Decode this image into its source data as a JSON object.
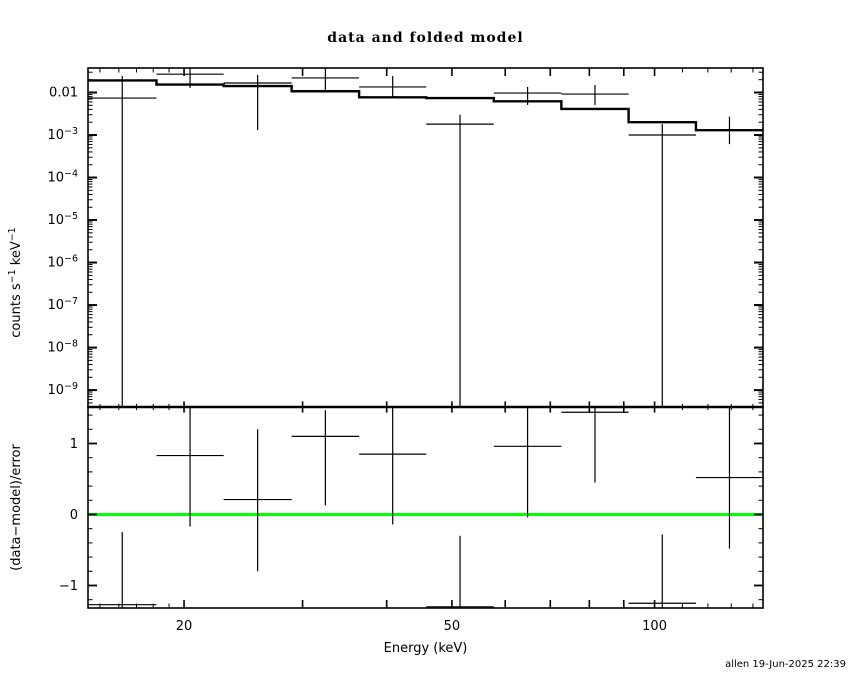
{
  "chart_data": {
    "type": "line",
    "title": "data and folded model",
    "footer": "allen 19-Jun-2025 22:39",
    "xlabel": "Energy (keV)",
    "xscale": "log",
    "xlim": [
      14.4,
      144.9
    ],
    "xticks": {
      "major": [
        20,
        30,
        40,
        50,
        60,
        70,
        80,
        90,
        100
      ],
      "minor": [
        15,
        16,
        17,
        18,
        19,
        110,
        120,
        130,
        140
      ],
      "labeled": [
        {
          "v": 20,
          "label": "20"
        },
        {
          "v": 50,
          "label": "50"
        },
        {
          "v": 100,
          "label": "100"
        }
      ]
    },
    "bin_edges_keV": [
      14.4,
      18.2,
      22.9,
      28.9,
      36.4,
      45.8,
      57.7,
      72.7,
      91.5,
      115.2,
      144.9
    ],
    "top_panel": {
      "ylabel": "counts s^-1 keV^-1",
      "yscale": "log",
      "ylim": [
        4e-10,
        0.0377
      ],
      "yticks": [
        {
          "v": 0.01,
          "label": "0.01"
        },
        {
          "v": 0.001,
          "label": "10^-3"
        },
        {
          "v": 0.0001,
          "label": "10^-4"
        },
        {
          "v": 1e-05,
          "label": "10^-5"
        },
        {
          "v": 1e-06,
          "label": "10^-6"
        },
        {
          "v": 1e-07,
          "label": "10^-7"
        },
        {
          "v": 1e-08,
          "label": "10^-8"
        },
        {
          "v": 1e-09,
          "label": "10^-9"
        }
      ],
      "data_counts": [
        0.0074,
        0.027,
        0.0167,
        0.022,
        0.0135,
        0.0018,
        0.0097,
        0.0092,
        0.001,
        0.0013
      ],
      "err_hi": [
        0.0244,
        null,
        0.0258,
        null,
        0.0244,
        0.003,
        0.0135,
        0.015,
        0.0018,
        0.0027
      ],
      "err_lo": [
        null,
        0.0128,
        0.0013,
        0.0103,
        0.0074,
        null,
        0.0051,
        0.0051,
        null,
        0.00061
      ],
      "model": [
        0.0192,
        0.0154,
        0.0142,
        0.0107,
        0.0077,
        0.0074,
        0.0062,
        0.0041,
        0.002,
        0.0013
      ]
    },
    "bottom_panel": {
      "ylabel": "(data−model)/error",
      "ylim": [
        -1.317,
        1.514
      ],
      "yticks": [
        {
          "v": 1,
          "label": "1"
        },
        {
          "v": 0,
          "label": "0"
        },
        {
          "v": -1,
          "label": "−1"
        }
      ],
      "minor_step": 0.2,
      "zero_line_color": "#00ff00",
      "residuals": [
        -1.27,
        0.83,
        0.21,
        1.1,
        0.85,
        -1.3,
        0.96,
        1.44,
        -1.25,
        0.52
      ],
      "res_hi": [
        -0.25,
        null,
        1.2,
        1.47,
        null,
        -0.3,
        null,
        null,
        -0.28,
        null
      ],
      "res_lo": [
        null,
        -0.17,
        -0.8,
        0.13,
        -0.14,
        null,
        -0.04,
        0.45,
        null,
        -0.48
      ]
    },
    "line_color": "#000000"
  }
}
